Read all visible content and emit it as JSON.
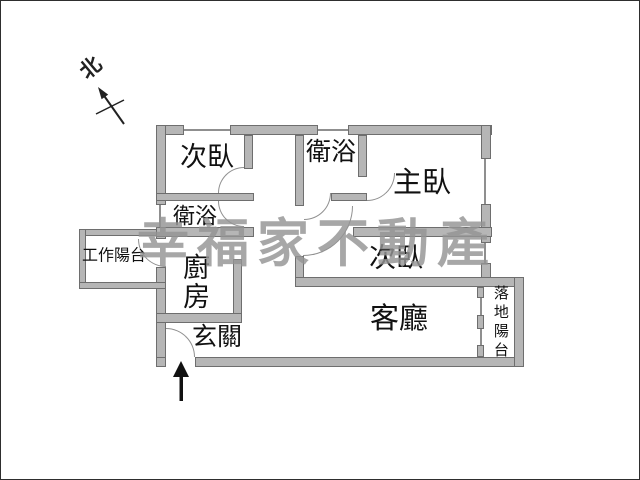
{
  "compass": {
    "label": "北"
  },
  "watermark": {
    "text": "幸福家不動產"
  },
  "rooms": {
    "secondary_bedroom_top": {
      "label": "次臥"
    },
    "master_bathroom": {
      "label": "衛浴"
    },
    "master_bedroom": {
      "label": "主臥"
    },
    "small_bathroom": {
      "label": "衛浴"
    },
    "work_balcony": {
      "label": "工作陽台"
    },
    "kitchen": {
      "label": "廚房"
    },
    "secondary_bedroom_mid": {
      "label": "次臥"
    },
    "living_room": {
      "label": "客廳"
    },
    "entryway": {
      "label": "玄關"
    },
    "landing_balcony": {
      "label": "落地陽台"
    }
  },
  "colors": {
    "background": "#ffffff",
    "wall_fill": "#b6b6b6",
    "wall_border": "#6e6e6e",
    "window_line": "#8f8f8f",
    "label_text": "#111111",
    "watermark": "#949494"
  }
}
